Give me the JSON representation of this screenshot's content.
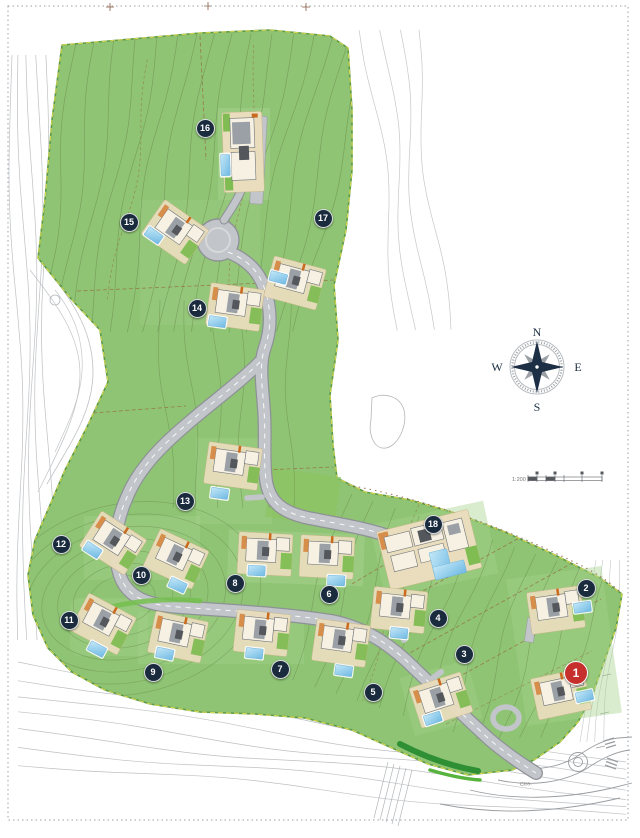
{
  "compass": {
    "north": "N",
    "east": "E",
    "south": "S",
    "west": "W"
  },
  "scale_bar": {
    "ratio_label": "1:200"
  },
  "road_label": {
    "text": "Ctra."
  },
  "marker_colors": {
    "default": "#1a2b3e",
    "highlight": "#c5302c"
  },
  "site_colors": {
    "grass": "#8fc474",
    "road": "#c2c5c9",
    "pool": "#8ccdf0"
  },
  "plots": [
    {
      "number": "1",
      "x": 575,
      "y": 672,
      "primary": true
    },
    {
      "number": "2",
      "x": 585,
      "y": 587
    },
    {
      "number": "3",
      "x": 463,
      "y": 653
    },
    {
      "number": "4",
      "x": 437,
      "y": 617
    },
    {
      "number": "5",
      "x": 372,
      "y": 691
    },
    {
      "number": "6",
      "x": 328,
      "y": 593
    },
    {
      "number": "7",
      "x": 279,
      "y": 668
    },
    {
      "number": "8",
      "x": 234,
      "y": 582
    },
    {
      "number": "9",
      "x": 152,
      "y": 671
    },
    {
      "number": "10",
      "x": 140,
      "y": 574
    },
    {
      "number": "11",
      "x": 68,
      "y": 619
    },
    {
      "number": "12",
      "x": 60,
      "y": 543
    },
    {
      "number": "13",
      "x": 184,
      "y": 500
    },
    {
      "number": "14",
      "x": 196,
      "y": 307
    },
    {
      "number": "15",
      "x": 128,
      "y": 221
    },
    {
      "number": "16",
      "x": 204,
      "y": 127
    },
    {
      "number": "17",
      "x": 322,
      "y": 217
    },
    {
      "number": "18",
      "x": 432,
      "y": 523
    }
  ]
}
